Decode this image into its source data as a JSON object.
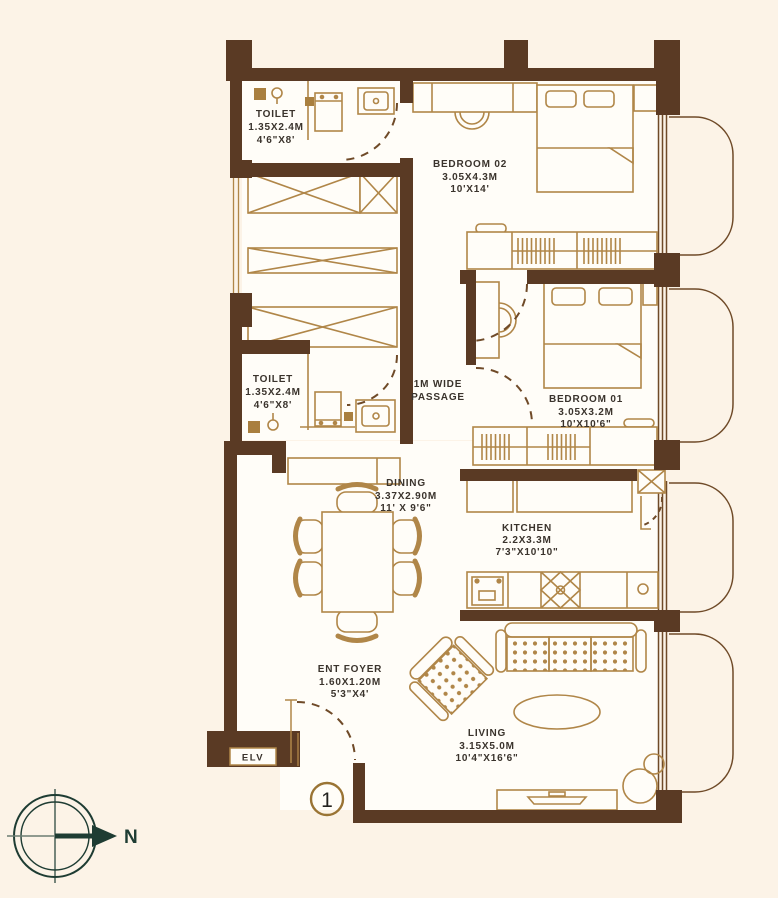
{
  "plan_title": "unit-floor-plan",
  "rooms": {
    "toilet_top": {
      "line1": "TOILET",
      "line2": "1.35X2.4M",
      "line3": "4'6\"X8'"
    },
    "toilet_mid": {
      "line1": "TOILET",
      "line2": "1.35X2.4M",
      "line3": "4'6\"X8'"
    },
    "bedroom_02": {
      "line1": "BEDROOM 02",
      "line2": "3.05X4.3M",
      "line3": "10'X14'"
    },
    "bedroom_01": {
      "line1": "BEDROOM 01",
      "line2": "3.05X3.2M",
      "line3": "10'X10'6\""
    },
    "passage": {
      "line1": "1M WIDE",
      "line2": "PASSAGE"
    },
    "dining": {
      "line1": "DINING",
      "line2": "3.37X2.90M",
      "line3": "11' X 9'6\""
    },
    "kitchen": {
      "line1": "KITCHEN",
      "line2": "2.2X3.3M",
      "line3": "7'3\"X10'10\""
    },
    "ent_foyer": {
      "line1": "ENT FOYER",
      "line2": "1.60X1.20M",
      "line3": "5'3\"X4'"
    },
    "living": {
      "line1": "LIVING",
      "line2": "3.15X5.0M",
      "line3": "10'4\"X16'6\""
    }
  },
  "labels": {
    "elevator": "ELV",
    "unit_number": "1",
    "compass_north": "N"
  },
  "colors": {
    "background": "#fcf3e7",
    "room_fill": "#fffdf8",
    "wall_brown": "#5a3a24",
    "furniture_gold": "#b08648",
    "swing_line_brown": "#6f4a28",
    "label_text": "#3a332c",
    "compass_green": "#1e3c33"
  }
}
